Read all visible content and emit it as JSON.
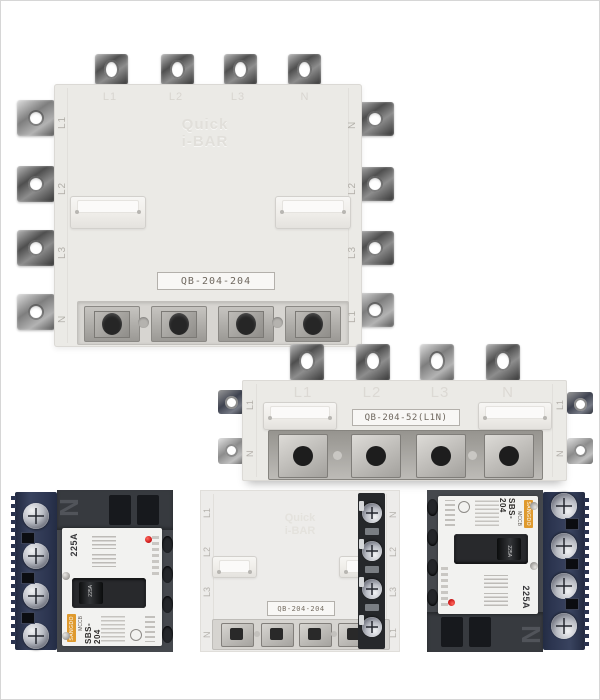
{
  "top_device": {
    "model": "QB-204-204",
    "emboss": [
      "Quick",
      "i-BAR"
    ],
    "face_labels": [
      "L1",
      "L2",
      "L3",
      "N"
    ],
    "left_labels": [
      "L1",
      "L2",
      "L3",
      "N"
    ],
    "right_labels": [
      "N",
      "L2",
      "L3",
      "L1"
    ]
  },
  "middle_device": {
    "model": "QB-204-52(L1N)",
    "face_labels": [
      "L1",
      "L2",
      "L3",
      "N"
    ],
    "left_labels": [
      "L1",
      "N"
    ],
    "right_labels": [
      "L1",
      "N"
    ]
  },
  "bottom": {
    "device": {
      "model": "QB-204-204",
      "emboss": [
        "Quick",
        "i-BAR"
      ],
      "left_labels": [
        "L1",
        "L2",
        "L3",
        "N"
      ],
      "right_labels": [
        "N",
        "L2",
        "L3",
        "L1"
      ]
    },
    "breaker": {
      "housing_letter": "N",
      "rating": "225A",
      "toggle_label": "225A",
      "brand": "SANGDO",
      "type_label": "MCCB",
      "model": "SBS-204"
    }
  },
  "colors": {
    "background": "#ffffff",
    "device_body": "#ebeae6",
    "breaker_housing": "#45484d",
    "terminal_blue": "#2e3750",
    "indicator_red": "#d01d1d",
    "brand_orange": "#df9a2e"
  }
}
